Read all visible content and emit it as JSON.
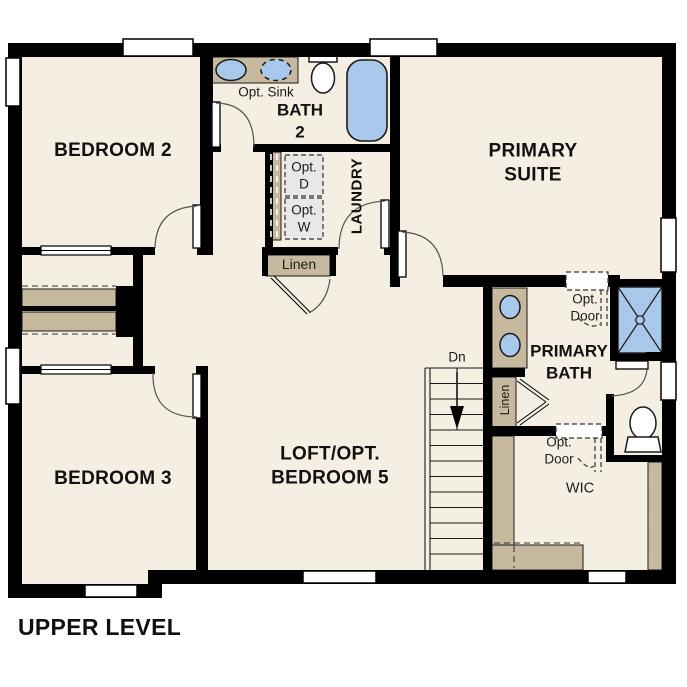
{
  "title": "UPPER LEVEL",
  "rooms": {
    "bedroom2": "BEDROOM 2",
    "bath2": "BATH\n2",
    "primary_suite": "PRIMARY\nSUITE",
    "laundry": "LAUNDRY",
    "bedroom3": "BEDROOM 3",
    "loft": "LOFT/OPT.\nBEDROOM 5",
    "primary_bath": "PRIMARY\nBATH",
    "wic": "WIC"
  },
  "labels": {
    "opt_sink": "Opt. Sink",
    "opt_dryer": "Opt.\nD",
    "opt_washer": "Opt.\nW",
    "linen_hall": "Linen",
    "linen_primary": "Linen",
    "opt_door_suite": "Opt.\nDoor",
    "opt_door_wic": "Opt.\nDoor",
    "stairs_down": "Dn"
  },
  "colors": {
    "wall": "#000000",
    "floor": "#f5eee2",
    "casework_tan": "#c7b99e",
    "fixture_blue": "#a9c9ec",
    "appliance_gray": "#e8e8e6",
    "line": "#444444"
  }
}
